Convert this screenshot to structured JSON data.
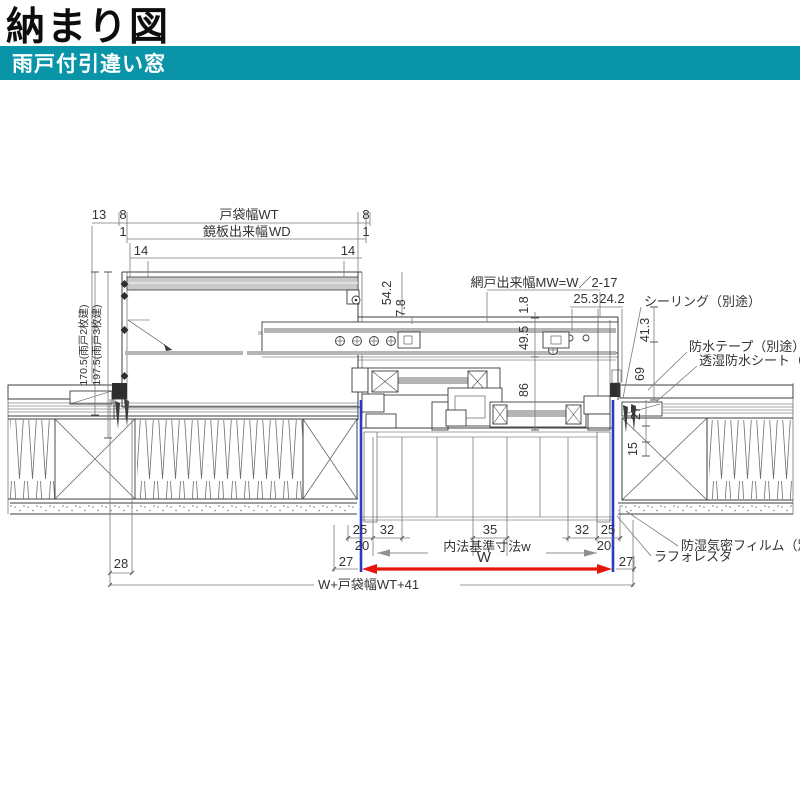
{
  "header": {
    "title": "納まり図",
    "subtitle": "雨戸付引違い窓"
  },
  "colors": {
    "teal": "#0994A8",
    "magenta": "#E5007E",
    "red": "#E8150D",
    "blue": "#2B3BC0",
    "tan": "#F3DFA6"
  },
  "top_dims": {
    "d13": "13",
    "d8": "8",
    "d1": "1",
    "d14": "14",
    "todana_width": "戸袋幅WT",
    "kagamiita": "鏡板出来幅",
    "kagamiita_code": "WD"
  },
  "left_dims": {
    "amado2": "170.5(雨戸2枚建)",
    "amado3": "197.5(雨戸3枚建)"
  },
  "frame_dims": {
    "d54_2": "54.2",
    "d7_8": "7.8",
    "d1_8": "1.8",
    "d49_5": "49.5",
    "d86": "86",
    "d25_3": "25.3",
    "d24_2": "24.2",
    "d41_3": "41.3",
    "d69": "69",
    "d27": "27",
    "d15": "15",
    "amido_width": "網戸出来幅MW=W／2-17"
  },
  "notes": {
    "sealing": "シーリング（別途）",
    "waterproof_tape": "防水テープ（別途）",
    "breathable_sheet": "透湿防水シート（別途）",
    "vapor_film": "防湿気密フィルム（別途）",
    "laforesta": "ラフォレスタ"
  },
  "bottom_dims": {
    "d25": "25",
    "d32": "32",
    "d35": "35",
    "d20": "20",
    "d27": "27",
    "d28": "28",
    "naihou": "内法基準寸法w",
    "w": "W",
    "w_total": "W+戸袋幅WT+41"
  }
}
